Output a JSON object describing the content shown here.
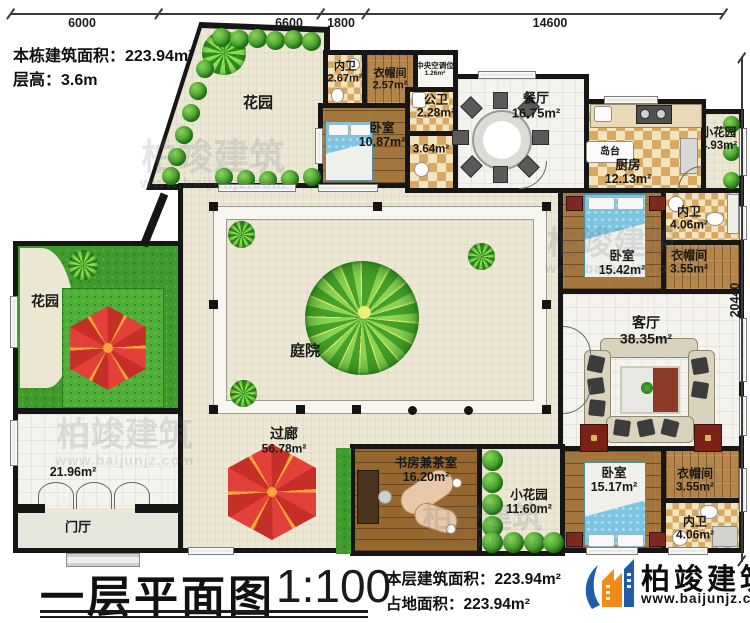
{
  "notes": {
    "building_area": "本栋建筑面积：223.94m²",
    "floor_height": "层高：3.6m"
  },
  "dimensions": {
    "top": [
      "6000",
      "6600",
      "1800",
      "14600"
    ],
    "right": "20440"
  },
  "rooms": {
    "garden_top": {
      "label": "花园",
      "area": ""
    },
    "bath_inner_top": {
      "label": "内卫",
      "area": "2.67m²"
    },
    "cloak_top": {
      "label": "衣帽间",
      "area": "2.57m²"
    },
    "hvac": {
      "label": "中央空调位",
      "area": "1.26m²"
    },
    "bath_public": {
      "label": "公卫",
      "area": "2.28m²"
    },
    "bedroom_top": {
      "label": "卧室",
      "area": "10.87m²"
    },
    "hall_364": {
      "label": "",
      "area": "3.64m²"
    },
    "dining": {
      "label": "餐厅",
      "area": "16.75m²"
    },
    "island": {
      "label": "岛台",
      "area": ""
    },
    "kitchen": {
      "label": "厨房",
      "area": "12.13m²"
    },
    "garden_small_tr": {
      "label": "小花园",
      "area": "4.93m²"
    },
    "bath_inner_r": {
      "label": "内卫",
      "area": "4.06m²"
    },
    "bedroom_right": {
      "label": "卧室",
      "area": "15.42m²"
    },
    "cloak_right": {
      "label": "衣帽间",
      "area": "3.55m²"
    },
    "living": {
      "label": "客厅",
      "area": "38.35m²"
    },
    "garden_left": {
      "label": "花园",
      "area": ""
    },
    "terrace": {
      "label": "",
      "area": "21.96m²"
    },
    "courtyard": {
      "label": "庭院",
      "area": ""
    },
    "corridor": {
      "label": "过廊",
      "area": "56.78m²"
    },
    "foyer": {
      "label": "门厅",
      "area": ""
    },
    "study": {
      "label": "书房兼茶室",
      "area": "16.20m²"
    },
    "garden_small_b": {
      "label": "小花园",
      "area": "11.60m²"
    },
    "bedroom_bottom": {
      "label": "卧室",
      "area": "15.17m²"
    },
    "cloak_bottom": {
      "label": "衣帽间",
      "area": "3.55m²"
    },
    "bath_inner_b": {
      "label": "内卫",
      "area": "4.06m²"
    }
  },
  "footer": {
    "title": "一层平面图",
    "scale": "1:100",
    "floor_area": "本层建筑面积：223.94m²",
    "site_area": "占地面积：223.94m²"
  },
  "brand": {
    "name": "柏竣建筑",
    "site": "www.baijunjz.com"
  },
  "colors": {
    "wall": "#161616",
    "grass": "#3f9b2e",
    "wood": "#a3763e",
    "floor": "#ebe7d3",
    "umbrella_red": "#e4403a",
    "logo_blue": "#1f5dab",
    "logo_orange": "#f28a1b"
  }
}
